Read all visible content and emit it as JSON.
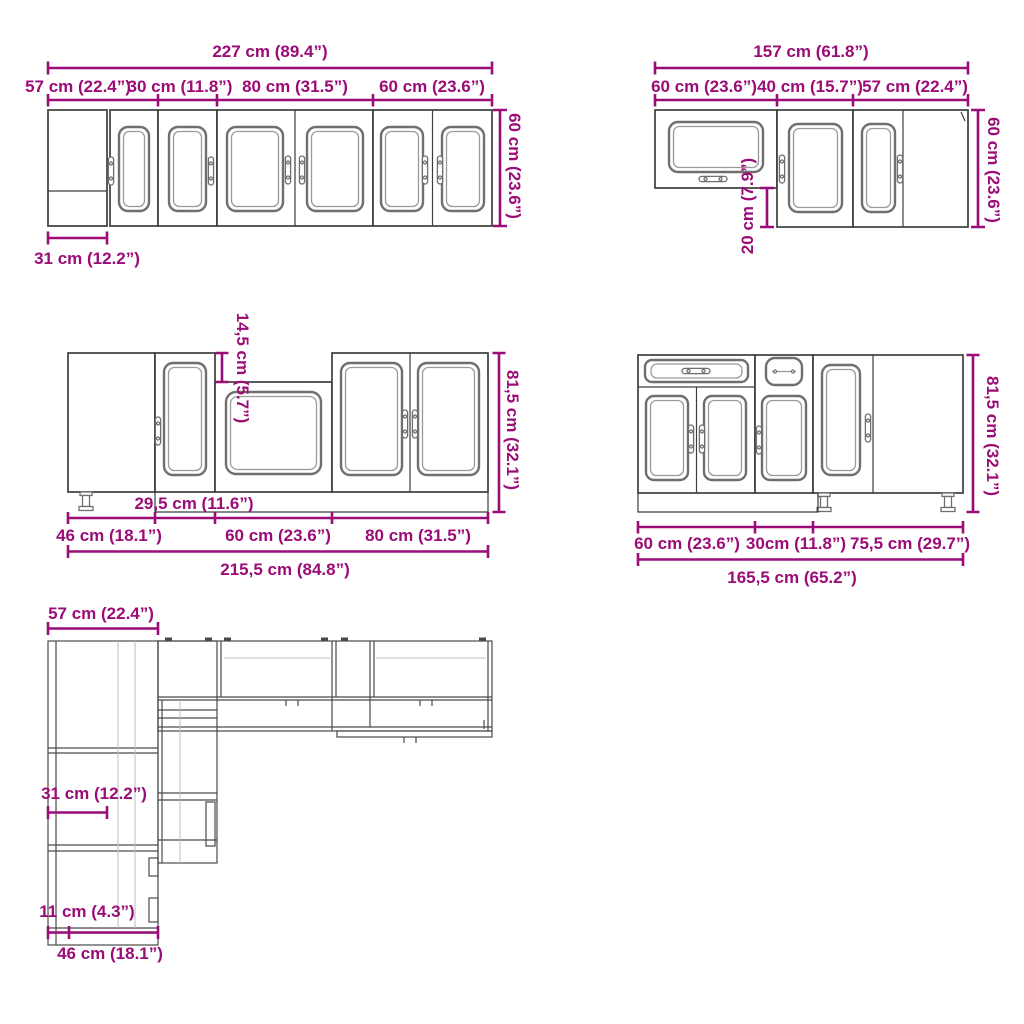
{
  "colors": {
    "dimension_text": "#9b0c76",
    "cabinet_outline": "#3d3d3d",
    "door_panel": "#6f6f6f",
    "background": "#ffffff"
  },
  "wall_row_left": {
    "overall_width": "227 cm (89.4”)",
    "segment_widths": [
      "57 cm (22.4”)",
      "30 cm (11.8”)",
      "80 cm (31.5”)",
      "60 cm (23.6”)"
    ],
    "height": "60 cm (23.6”)",
    "corner_blind_width": "31 cm (12.2”)"
  },
  "wall_row_right": {
    "overall_width": "157 cm (61.8”)",
    "segment_widths": [
      "60 cm (23.6”)",
      "40 cm (15.7”)",
      "57 cm (22.4”)"
    ],
    "height": "60 cm (23.6”)",
    "bottom_offset": "20 cm (7.9”)"
  },
  "base_row_left": {
    "overall_width": "215,5 cm (84.8”)",
    "segment_widths": [
      "46 cm (18.1”)",
      "60 cm (23.6”)",
      "80 cm (31.5”)"
    ],
    "door_unit_width": "29,5 cm (11.6”)",
    "height": "81,5 cm (32.1”)",
    "sink_top_drop": "14,5 cm (5.7”)"
  },
  "base_row_right": {
    "overall_width": "165,5 cm (65.2”)",
    "segment_widths": [
      "60 cm (23.6”)",
      "30cm (11.8”)",
      "75,5 cm (29.7”)"
    ],
    "height": "81,5 cm (32.1”)"
  },
  "plan_view": {
    "corner_width": "57 cm (22.4”)",
    "blind_width": "31 cm (12.2”)",
    "gap_depth": "11 cm (4.3”)",
    "unit_depth": "46 cm (18.1”)"
  }
}
